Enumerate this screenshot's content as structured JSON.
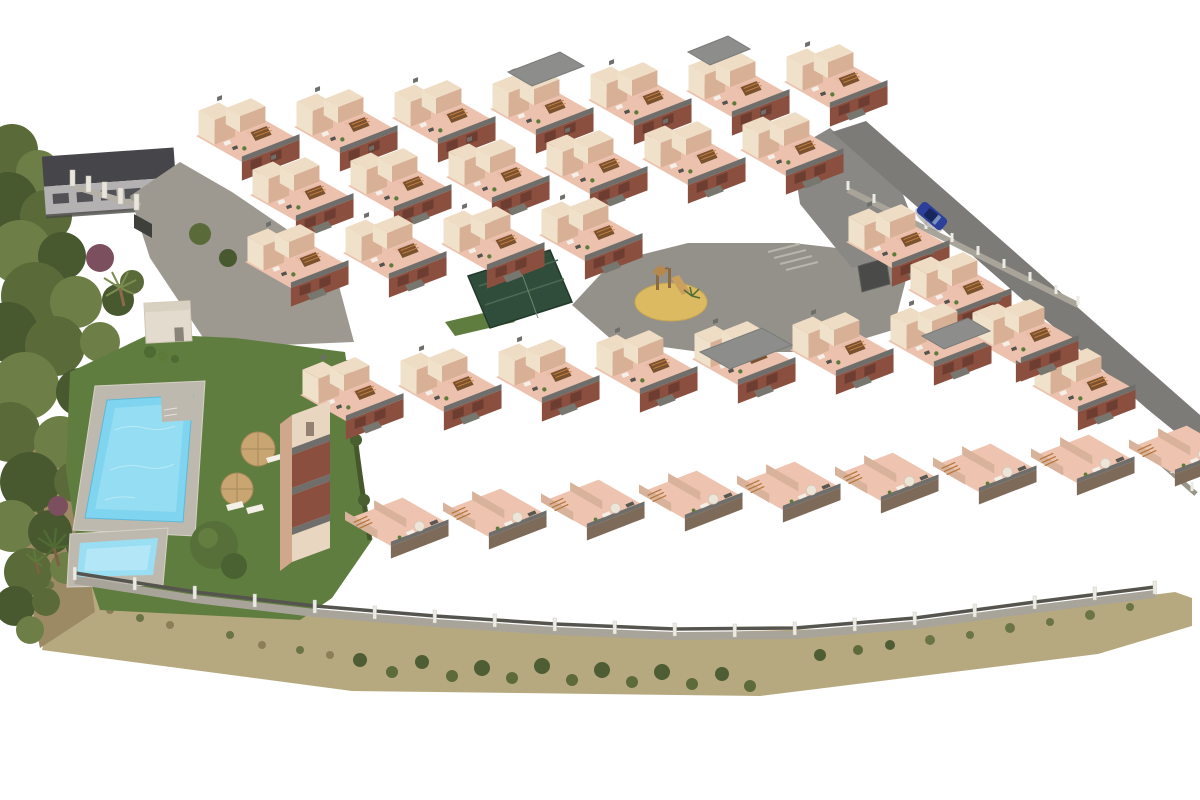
{
  "scene": {
    "type": "aerial-3d-architectural-render",
    "title": "Aerial render of a hillside apartment complex",
    "features": [
      "pine forest strip on the left edge",
      "communal lawn with large swimming pool and children's pool",
      "two straw parasols with sun loungers",
      "central paved plaza with sand playground and wooden play structure",
      "padel court with dark green enclosure",
      "five staggered rows of cream and terracotta apartment modules with roof terraces",
      "diagonal perimeter access road with one parked blue car",
      "masonry perimeter fence with white posts",
      "dry scrubland strip along the lower boundary",
      "neighbouring grey-roofed building at the top left"
    ],
    "apartment_module_count": 39,
    "pool_count": 2,
    "parasol_count": 2,
    "car_count": 1
  },
  "colors": {
    "background": "#ffffff",
    "lawn": "#5f7d3e",
    "forest_dark": "#48582f",
    "forest_mid": "#5a6b39",
    "forest_light": "#6d7f47",
    "shrub_purple": "#7c4f5e",
    "pool_water": "#7fd4ef",
    "pool_water_light": "#a8e3f6",
    "kids_pool": "#9adef4",
    "pool_deck": "#beb9ae",
    "pool_house": "#e3dbcd",
    "wall_cream": "#f0e1ca",
    "wall_tan": "#d7b096",
    "wall_top": "#eedcc4",
    "terrace_pink": "#ecc2ae",
    "terrace_pink_light": "#eec4b0",
    "terrace_mottle": "#e0ad98",
    "brick": "#8a4f3f",
    "railing": "#6f6e6a",
    "stair_wood": "#7a5230",
    "stair_slat": "#c8803e",
    "roof_gray": "#8d8e8c",
    "plaza": "#94918a",
    "road": "#7d7b78",
    "apron": "#8a8884",
    "sand": "#dcba62",
    "play_wood": "#a97f48",
    "car_blue": "#2b3f9b",
    "fence_dark": "#55544e",
    "fence_post": "#eceae4",
    "fence_wall": "#a9a49a",
    "scrub_base": "#b7a97f",
    "scrub_green": "#4e5d33",
    "scrub_brown": "#8b7f57",
    "bg_building_roof": "#46464a",
    "bg_building_wall": "#b3b1b1",
    "court_green": "#2f4d3a",
    "parasol": "#c8a571",
    "driveway": "#9d9990"
  }
}
